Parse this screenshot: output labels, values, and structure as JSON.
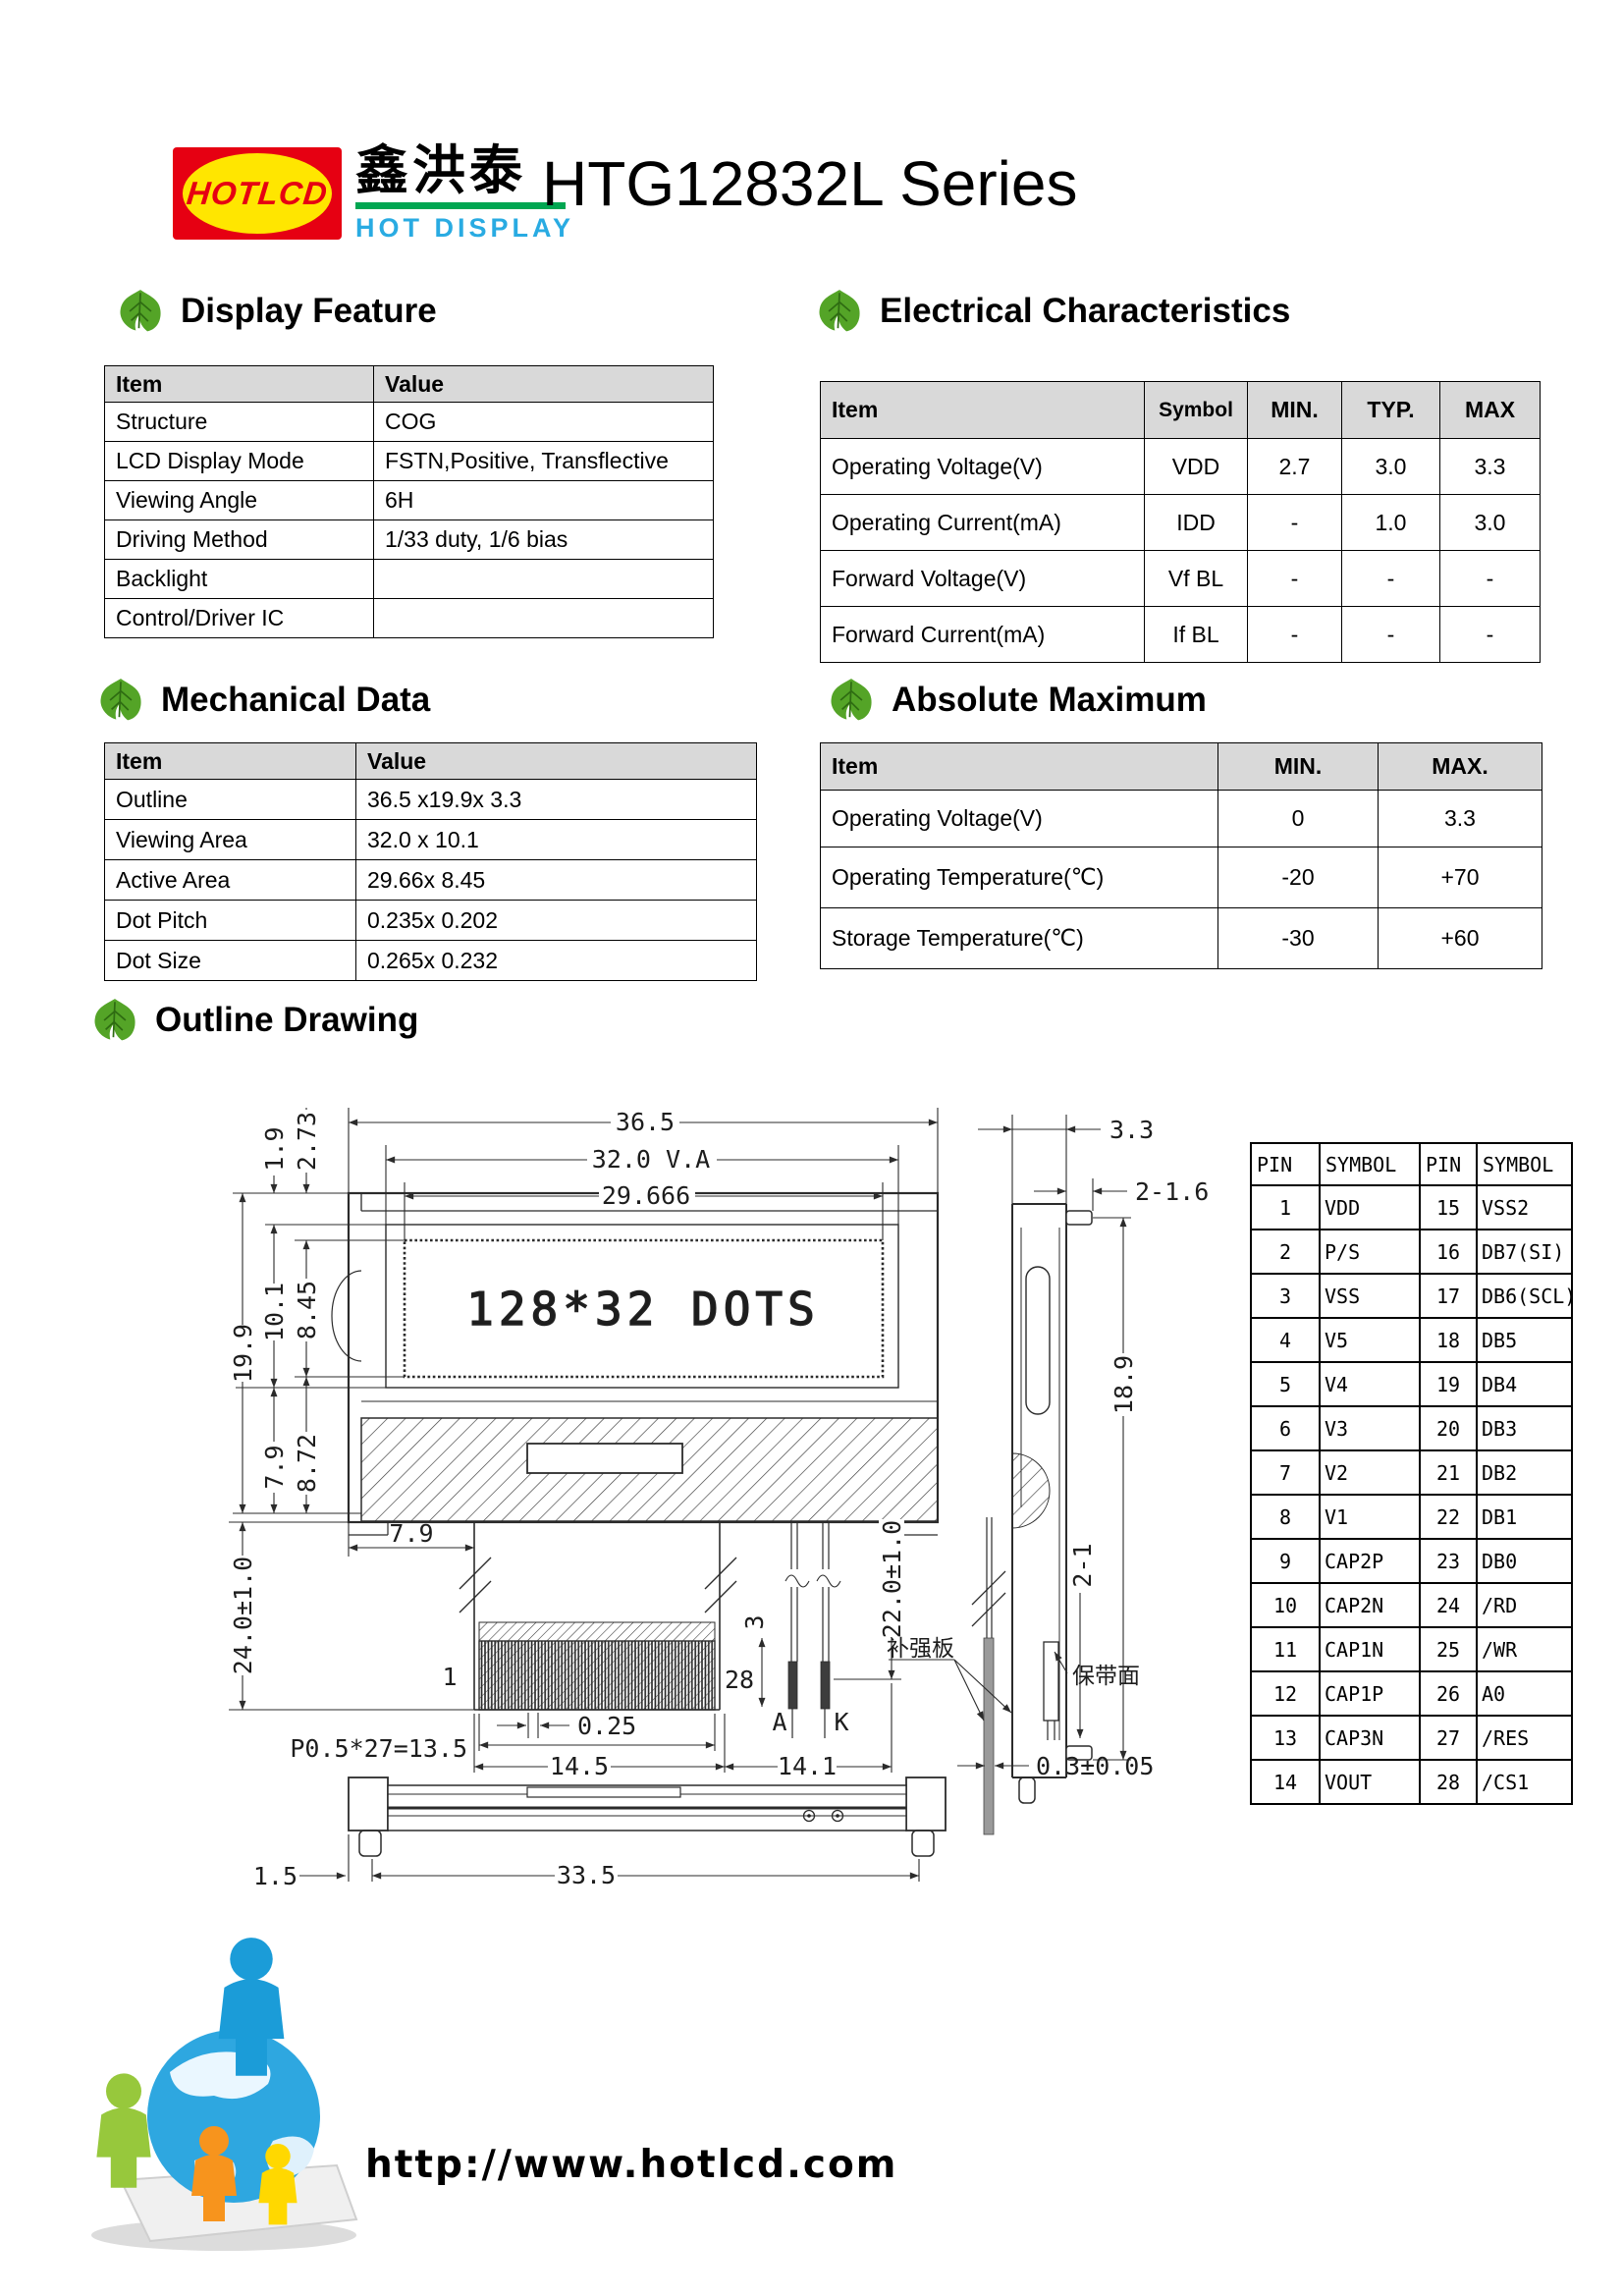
{
  "logo": {
    "text": "HOTLCD",
    "chinese": "鑫洪泰",
    "tagline": "HOT DISPLAY"
  },
  "page": {
    "title": "HTG12832L Series"
  },
  "sections": {
    "display_feature": {
      "heading": "Display Feature",
      "col_item": "Item",
      "col_value": "Value",
      "rows": [
        {
          "item": "Structure",
          "value": "COG"
        },
        {
          "item": "LCD Display Mode",
          "value": "FSTN,Positive, Transflective"
        },
        {
          "item": "Viewing Angle",
          "value": "6H"
        },
        {
          "item": "Driving Method",
          "value": "1/33 duty, 1/6 bias"
        },
        {
          "item": "Backlight",
          "value": ""
        },
        {
          "item": "Control/Driver IC",
          "value": ""
        }
      ]
    },
    "electrical": {
      "heading": "Electrical Characteristics",
      "col_item": "Item",
      "col_symbol": "Symbol",
      "col_min": "MIN.",
      "col_typ": "TYP.",
      "col_max": "MAX",
      "rows": [
        {
          "item": "Operating Voltage(V)",
          "symbol": "VDD",
          "min": "2.7",
          "typ": "3.0",
          "max": "3.3"
        },
        {
          "item": "Operating Current(mA)",
          "symbol": "IDD",
          "min": "-",
          "typ": "1.0",
          "max": "3.0"
        },
        {
          "item": "Forward Voltage(V)",
          "symbol": "Vf BL",
          "min": "-",
          "typ": "-",
          "max": "-"
        },
        {
          "item": "Forward Current(mA)",
          "symbol": "If BL",
          "min": "-",
          "typ": "-",
          "max": "-"
        }
      ]
    },
    "mechanical": {
      "heading": "Mechanical Data",
      "col_item": "Item",
      "col_value": "Value",
      "rows": [
        {
          "item": "Outline",
          "value": "36.5 x19.9x 3.3"
        },
        {
          "item": "Viewing Area",
          "value": "32.0 x 10.1"
        },
        {
          "item": "Active Area",
          "value": "29.66x 8.45"
        },
        {
          "item": "Dot Pitch",
          "value": "0.235x 0.202"
        },
        {
          "item": "Dot Size",
          "value": "0.265x 0.232"
        }
      ]
    },
    "absolute_maximum": {
      "heading": "Absolute Maximum",
      "col_item": "Item",
      "col_min": "MIN.",
      "col_max": "MAX.",
      "rows": [
        {
          "item": "Operating Voltage(V)",
          "min": "0",
          "max": "3.3"
        },
        {
          "item": "Operating Temperature(℃)",
          "min": "-20",
          "max": "+70"
        },
        {
          "item": "Storage Temperature(℃)",
          "min": "-30",
          "max": "+60"
        }
      ]
    },
    "outline_drawing": {
      "heading": "Outline Drawing"
    }
  },
  "drawing": {
    "lcd_text": "128*32 DOTS",
    "dims": {
      "total_width": "36.5",
      "va_width": "32.0  V.A",
      "aa_width": "29.666",
      "bezel_top": "1.9",
      "va_top": "2.73",
      "total_height": "19.9",
      "va_height": "10.1",
      "aa_height": "8.45",
      "lower_left": "7.9",
      "lower_right": "8.72",
      "tail_offset": "7.9",
      "tail_length": "24.0±1.0",
      "lead_length": "22.0±1.0",
      "pin_pitch": "P0.5*27=13.5",
      "pin_width": "0.25",
      "pin_span": "14.5",
      "lead_span": "14.1",
      "pin_first": "1",
      "pin_last": "28",
      "lead_tip": "3",
      "anode": "A",
      "cathode": "K",
      "thickness": "3.3",
      "top_holes": "2-1.6",
      "side_height": "18.9",
      "bottom_holes": "2-1",
      "fpc_thickness": "0.3±0.05",
      "foot_offset": "1.5",
      "mount_span": "33.5"
    },
    "notes": {
      "stiffener": "补强板",
      "tape_side": "保带面"
    }
  },
  "pin_table": {
    "headers": [
      "PIN",
      "SYMBOL",
      "PIN",
      "SYMBOL"
    ],
    "rows": [
      [
        "1",
        "VDD",
        "15",
        "VSS2"
      ],
      [
        "2",
        "P/S",
        "16",
        "DB7(SI)"
      ],
      [
        "3",
        "VSS",
        "17",
        "DB6(SCL)"
      ],
      [
        "4",
        "V5",
        "18",
        "DB5"
      ],
      [
        "5",
        "V4",
        "19",
        "DB4"
      ],
      [
        "6",
        "V3",
        "20",
        "DB3"
      ],
      [
        "7",
        "V2",
        "21",
        "DB2"
      ],
      [
        "8",
        "V1",
        "22",
        "DB1"
      ],
      [
        "9",
        "CAP2P",
        "23",
        "DB0"
      ],
      [
        "10",
        "CAP2N",
        "24",
        "/RD"
      ],
      [
        "11",
        "CAP1N",
        "25",
        "/WR"
      ],
      [
        "12",
        "CAP1P",
        "26",
        "A0"
      ],
      [
        "13",
        "CAP3N",
        "27",
        "/RES"
      ],
      [
        "14",
        "VOUT",
        "28",
        "/CS1"
      ]
    ]
  },
  "footer": {
    "url": "http://www.hotlcd.com"
  },
  "colors": {
    "accent_red": "#e60012",
    "logo_yellow": "#ffe600",
    "logo_green": "#00a651",
    "logo_cyan": "#29abe2",
    "leaf_green": "#54a427",
    "table_header_bg": "#d9d9d9"
  }
}
